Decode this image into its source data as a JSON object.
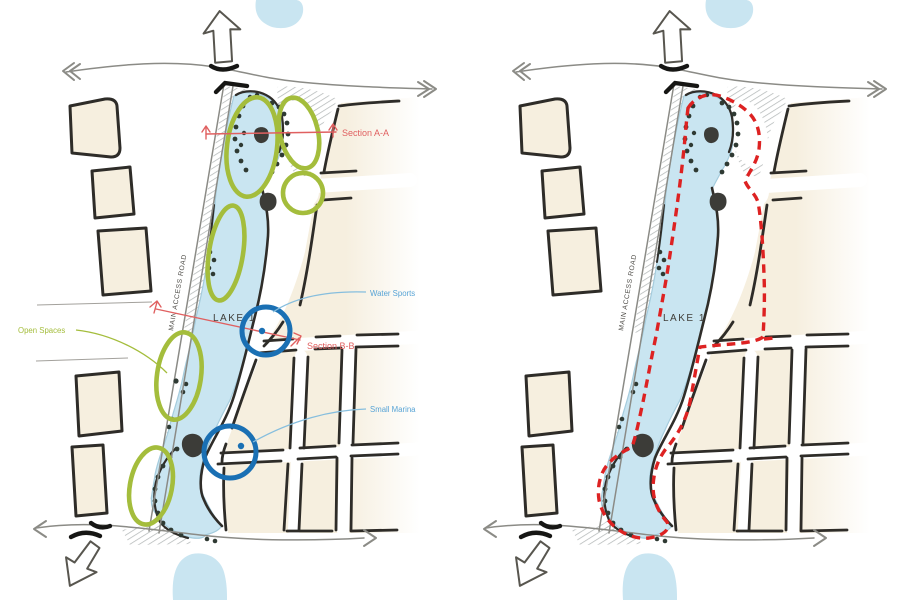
{
  "diagram": {
    "labels": {
      "lake": "LAKE 1",
      "main_access_road": "MAIN ACCESS ROAD",
      "open_spaces": "Open Spaces",
      "section_aa": "Section A-A",
      "section_bb": "Section B-B",
      "water_sports": "Water Sports",
      "small_marina": "Small Marina"
    },
    "colors": {
      "open_space_green": "#a4bd3c",
      "section_red": "#e06060",
      "route_red": "#dd2222",
      "marker_blue": "#1a70b4",
      "annotation_blue": "#58a4d6",
      "lake_blue": "#c9e5f1",
      "block_beige": "#f6efdf",
      "ink": "#2e2c28"
    }
  }
}
